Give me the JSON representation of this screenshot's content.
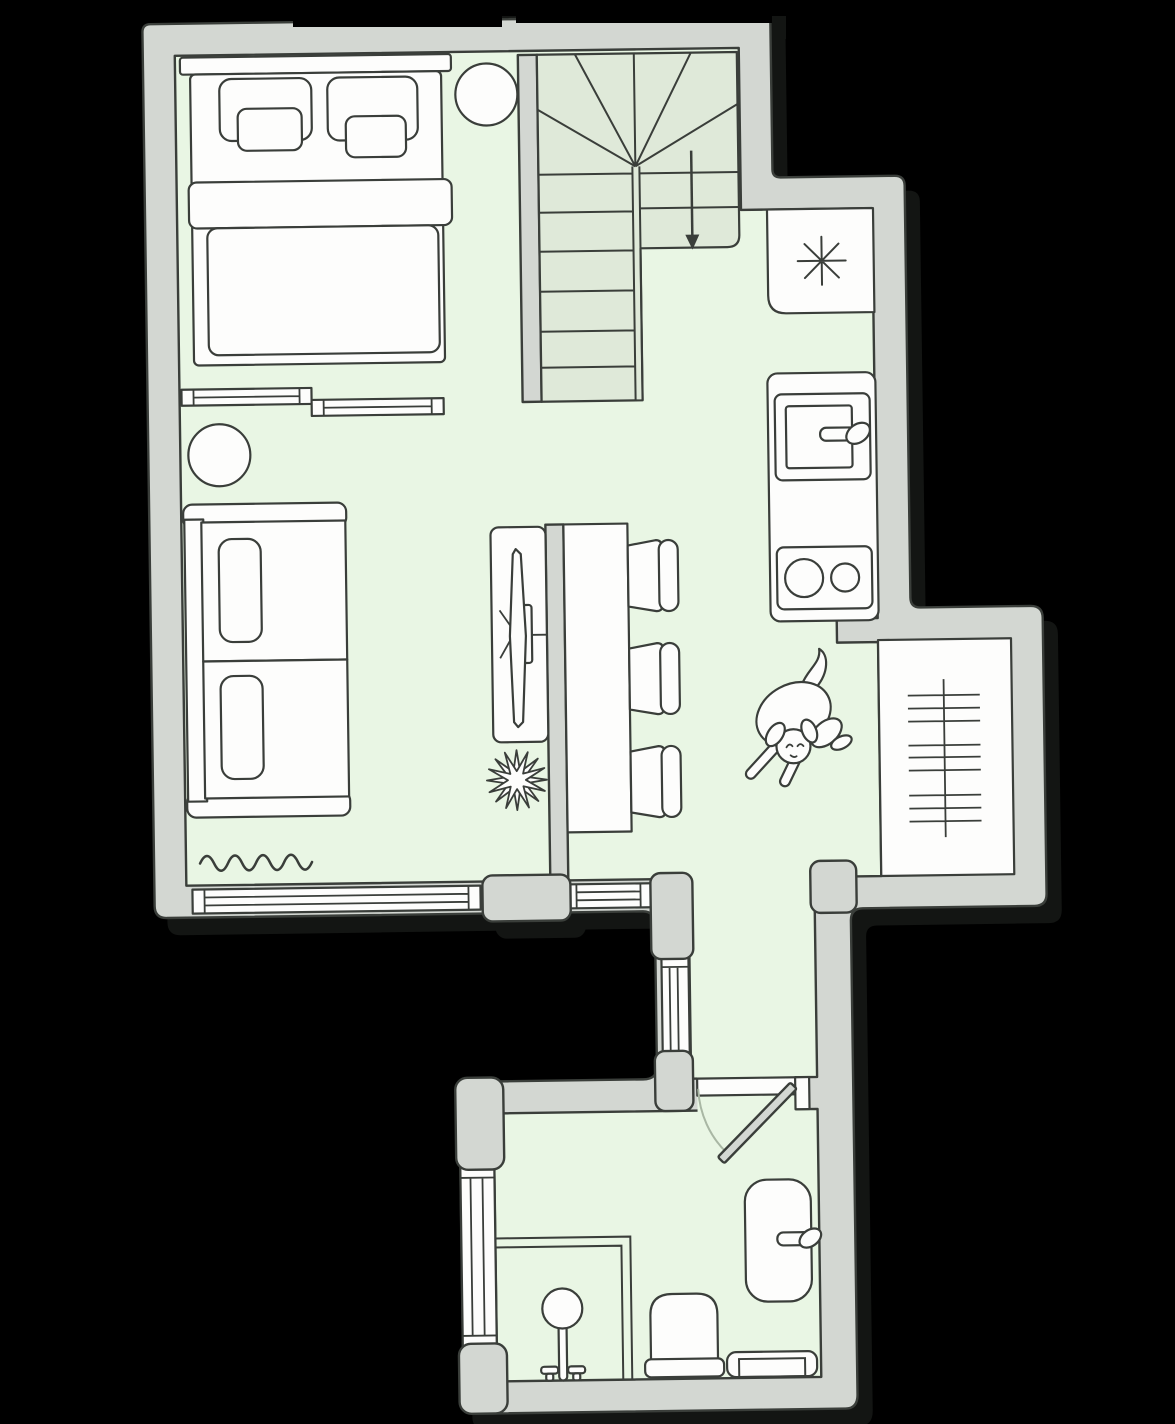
{
  "colors": {
    "background": "#000000",
    "wall_fill": "#d3d7d2",
    "outline": "#3a3e3a",
    "floor_fill": "#e9f6e4",
    "stairs_fill": "#dfe9d9",
    "furniture_fill": "#fdfdfc",
    "swing_arc": "#a9b7a4",
    "shadow": "#131513"
  },
  "plan": {
    "type": "apartment-floor-plan",
    "rooms": [
      {
        "name": "bedroom",
        "items": [
          "double-bed",
          "pillows",
          "round-nightstand",
          "sliding-door-panels",
          "round-stool"
        ]
      },
      {
        "name": "living-area",
        "items": [
          "two-seat-sofa",
          "tv-desk",
          "spiky-plant",
          "radiator-squiggle",
          "bottom-windows"
        ]
      },
      {
        "name": "dining-area",
        "items": [
          "dining-table",
          "three-chairs",
          "sleeping-dog"
        ]
      },
      {
        "name": "kitchen",
        "items": [
          "refrigerator-asterisk",
          "sink-counter",
          "two-burner-stove"
        ]
      },
      {
        "name": "staircase",
        "items": [
          "winder-stairs",
          "down-arrow"
        ]
      },
      {
        "name": "utility-niche",
        "items": [
          "radiator-ladder"
        ]
      },
      {
        "name": "corridor",
        "items": [
          "side-window"
        ]
      },
      {
        "name": "bathroom",
        "items": [
          "shower-corner",
          "toilet",
          "washbasin",
          "towel-radiator",
          "side-window",
          "swing-door"
        ]
      }
    ]
  }
}
